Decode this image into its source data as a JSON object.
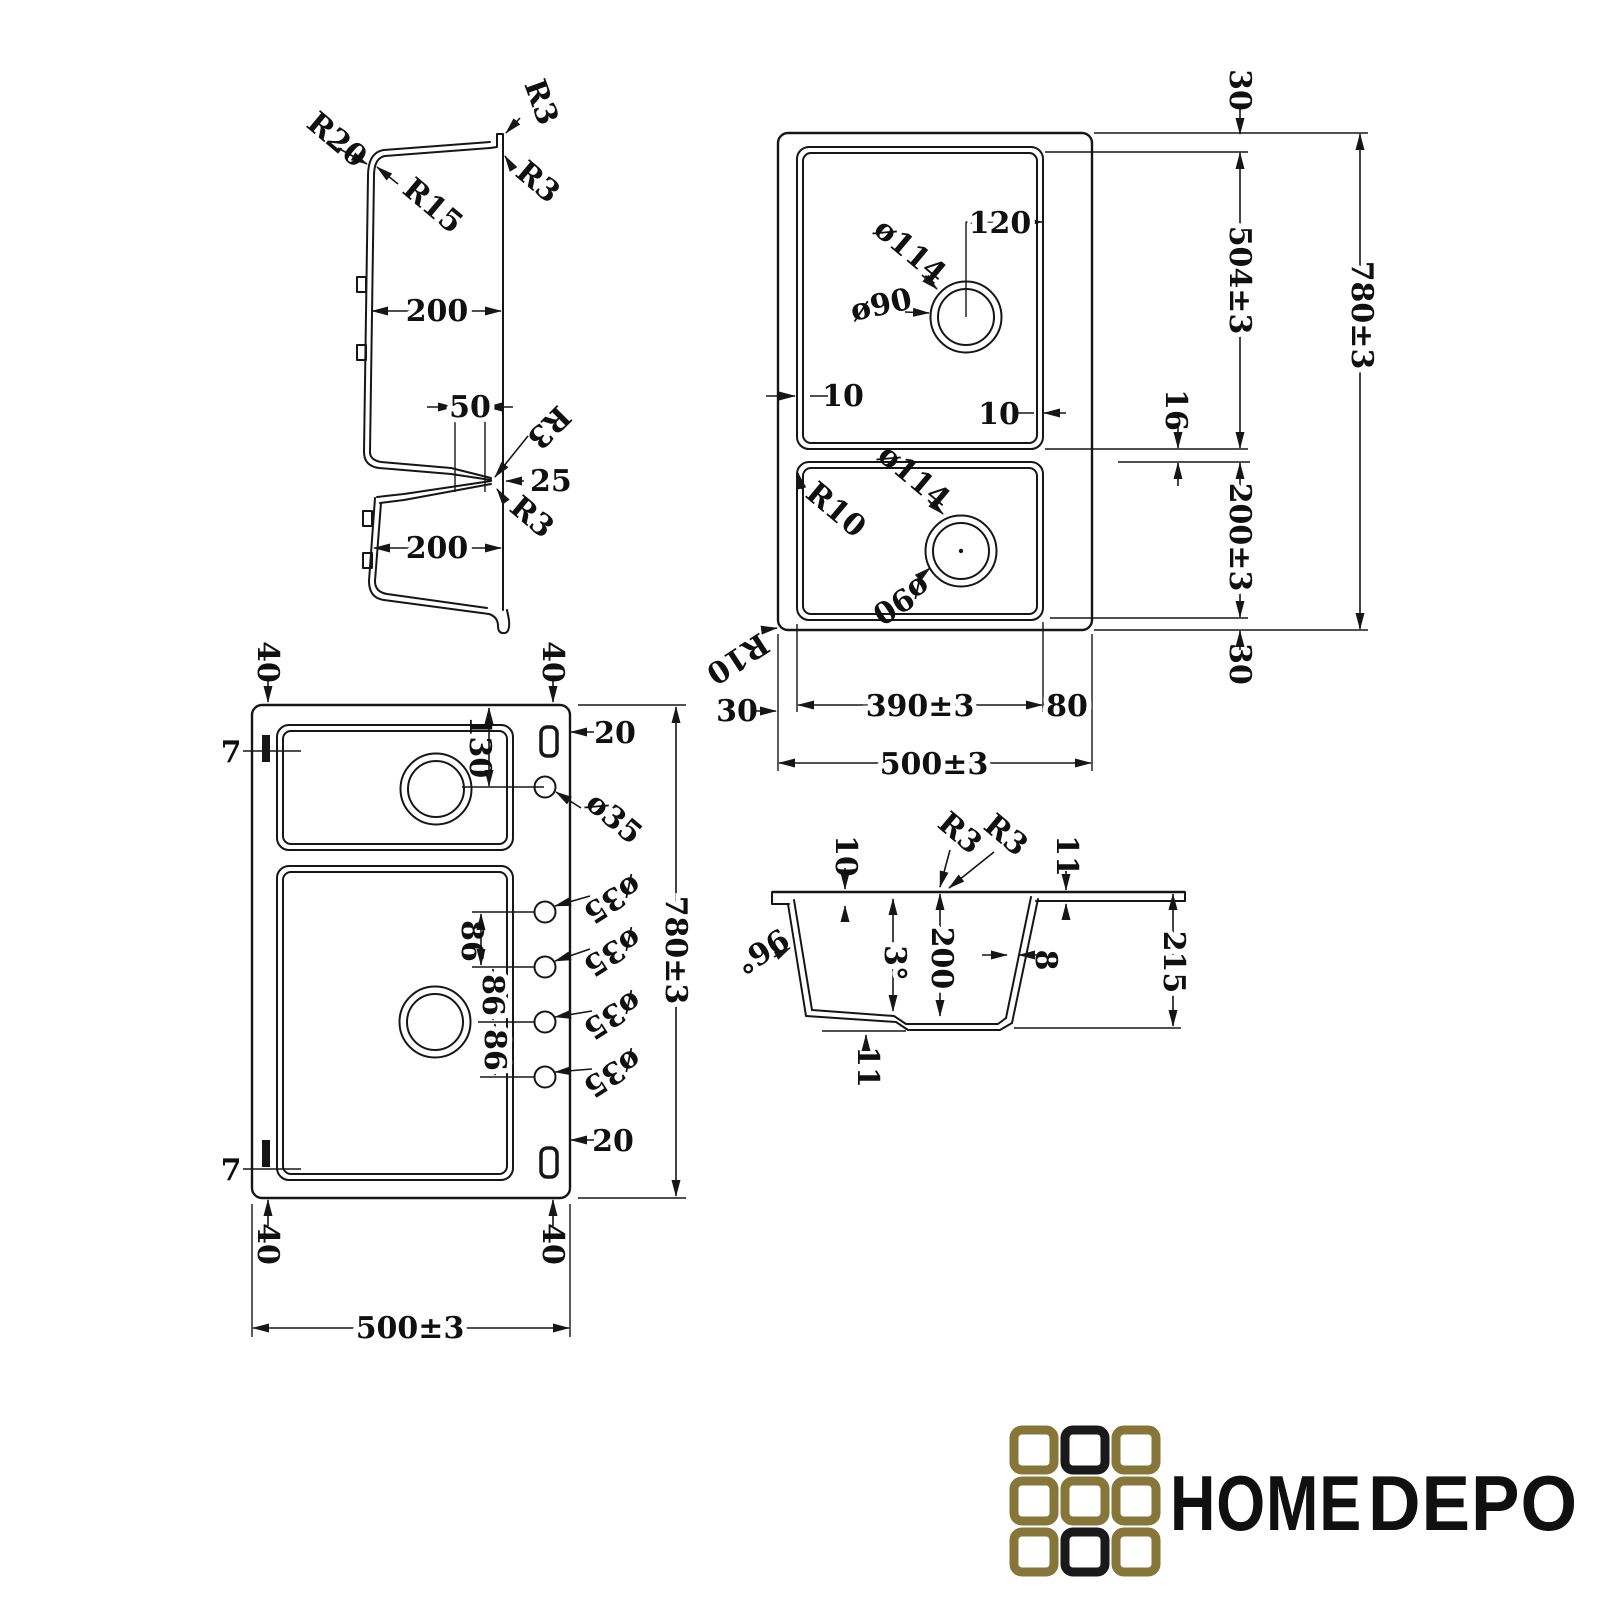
{
  "drawing": {
    "section_side": {
      "r20": "R20",
      "r3_top": "R3",
      "r15": "R15",
      "r3_right": "R3",
      "w200_top": "200",
      "w50": "50",
      "r3_mid": "R3",
      "d25": "25",
      "r3_low": "R3",
      "w200_bot": "200"
    },
    "plan_top": {
      "dia114_top": "ø114",
      "dia90_top": "ø90",
      "w120": "120",
      "t10_left": "10",
      "t10_right": "10",
      "dia114_bot": "ø114",
      "dia90_bot": "ø90",
      "r10_inner": "R10",
      "r10_outer": "R10",
      "h30_top": "30",
      "h504": "504±3",
      "h16": "16",
      "h200": "200±3",
      "h780": "780±3",
      "h30_bot": "30",
      "w30_left": "30",
      "w390": "390±3",
      "w80": "80",
      "w500": "500±3"
    },
    "plan_bottom": {
      "t40_tl": "40",
      "t40_tr": "40",
      "t7_top": "7",
      "t20_top": "20",
      "h130": "130",
      "dia35_1": "ø35",
      "dia35_2": "ø35",
      "dia35_3": "ø35",
      "dia35_4": "ø35",
      "dia35_5": "ø35",
      "s86_1": "86",
      "s86_2": "86",
      "s86_3": "86",
      "h780": "780±3",
      "t20_bot": "20",
      "t7_bot": "7",
      "t40_bl": "40",
      "t40_br": "40",
      "w500": "500±3"
    },
    "section_end": {
      "t10": "10",
      "r3_a": "R3",
      "r3_b": "R3",
      "t11_top": "11",
      "a96": "96°",
      "a3": "3°",
      "d200": "200",
      "t8": "8",
      "d215": "215",
      "t11_bot": "11"
    }
  },
  "logo": {
    "home": "HOME",
    "depo": "DEPO",
    "gold": "#86763a",
    "black": "#1a1a1a",
    "squares": [
      "gold",
      "black",
      "gold",
      "gold",
      "gold",
      "gold",
      "gold",
      "black",
      "gold"
    ]
  }
}
